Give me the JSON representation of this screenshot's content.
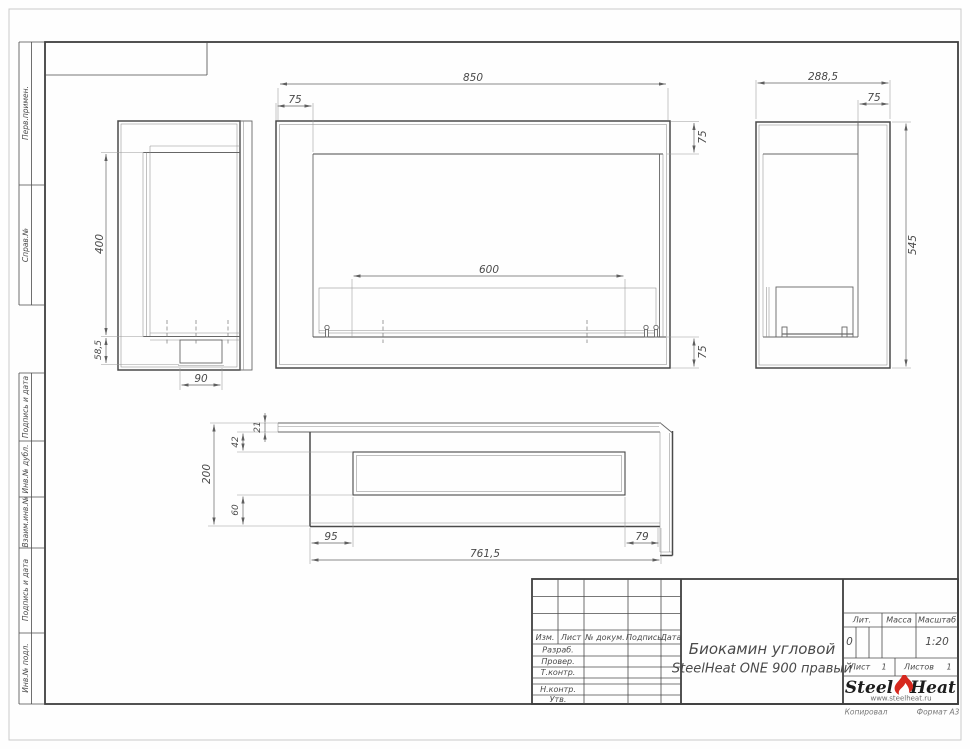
{
  "sheet": {
    "margin_labels": [
      "Перв.примен.",
      "Справ.№",
      "Подпись и дата",
      "Инв.№ дубл.",
      "Взаим.инв.№",
      "Подпись и дата",
      "Инв.№ подл."
    ]
  },
  "dimensions": {
    "front": {
      "width": "850",
      "left_offset": "75",
      "top_frame": "75",
      "burner": "600",
      "bottom_frame": "75"
    },
    "side_left": {
      "glass_height": "400",
      "base_height": "58,5",
      "tray_width": "90"
    },
    "side_right": {
      "depth": "288,5",
      "frame": "75",
      "height": "545"
    },
    "top": {
      "wall_gap": "21",
      "front_inset": "42",
      "depth": "200",
      "back_inset": "60",
      "left_offset": "95",
      "length": "761,5",
      "right_offset": "79"
    }
  },
  "title_block": {
    "rev_headers": [
      "Изм.",
      "Лист",
      "№ докум.",
      "Подпись",
      "Дата"
    ],
    "staff_rows": [
      "Разраб.",
      "Провер.",
      "Т.контр.",
      "Н.контр.",
      "Утв."
    ],
    "title_line1": "Биокамин угловой",
    "title_line2": "SteelHeat ONE 900 правый",
    "lit_label": "Лит.",
    "lit_value": "0",
    "mass_label": "Масса",
    "scale_label": "Масштаб",
    "scale_value": "1:20",
    "sheet_label": "Лист",
    "sheet_value": "1",
    "sheets_label": "Листов",
    "sheets_value": "1",
    "logo_steel": "Steel",
    "logo_heat": "Heat",
    "logo_url": "www.steelheat.ru",
    "copied_label": "Копировал",
    "format_label": "Формат А3",
    "accent_color": "#d6281e"
  }
}
